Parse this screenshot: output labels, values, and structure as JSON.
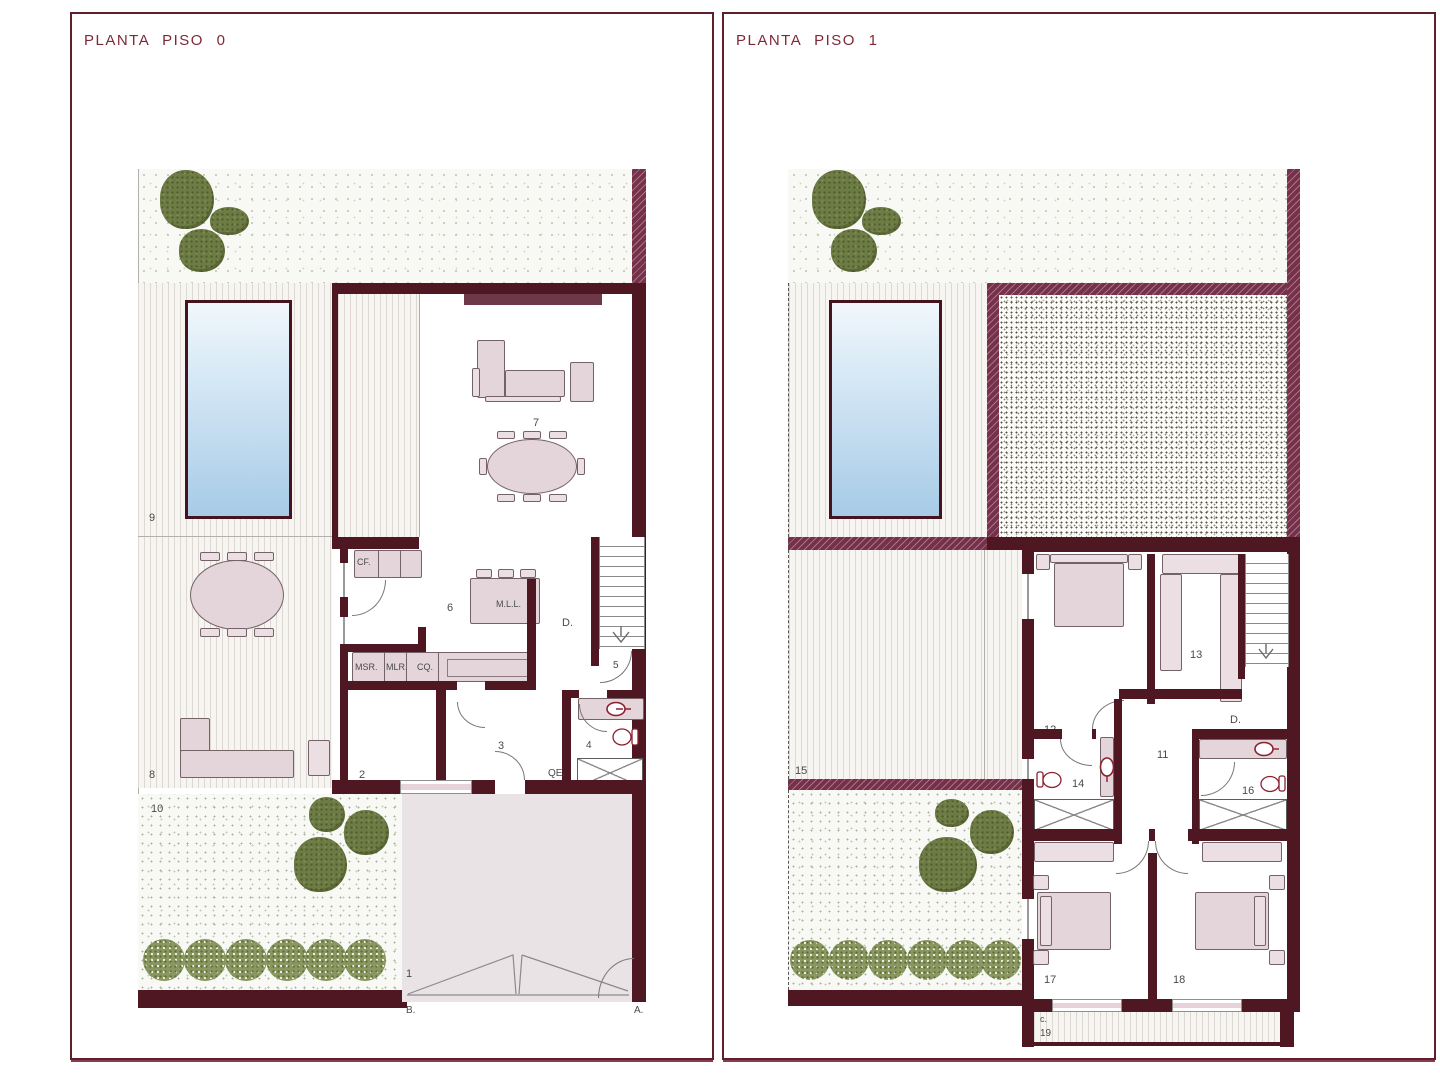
{
  "plan0": {
    "title": "PLANTA PISO 0",
    "rooms": {
      "r1": "1",
      "r2": "2",
      "r3": "3",
      "r4": "4",
      "r5": "5",
      "r6": "6",
      "r7": "7",
      "r8": "8",
      "r9": "9",
      "r10": "10"
    },
    "tags": {
      "cf": "CF.",
      "msr": "MSR.",
      "mlr": "MLR.",
      "cq": "CQ.",
      "mll": "M.L.L.",
      "d": "D.",
      "qe": "QE.",
      "b": "B.",
      "a": "A."
    }
  },
  "plan1": {
    "title": "PLANTA PISO 1",
    "rooms": {
      "r11": "11",
      "r12": "12",
      "r13": "13",
      "r14": "14",
      "r15": "15",
      "r16": "16",
      "r17": "17",
      "r18": "18",
      "r19": "19"
    },
    "tags": {
      "d": "D.",
      "c": "c."
    }
  },
  "colors": {
    "wall": "#4e1722",
    "hatch_wall": "#75304a",
    "title_text": "#7f2838",
    "furniture": "#e4d5da",
    "tree": "#6d7b44",
    "pool": "#a7cbe7",
    "label": "#4a4a4a"
  }
}
